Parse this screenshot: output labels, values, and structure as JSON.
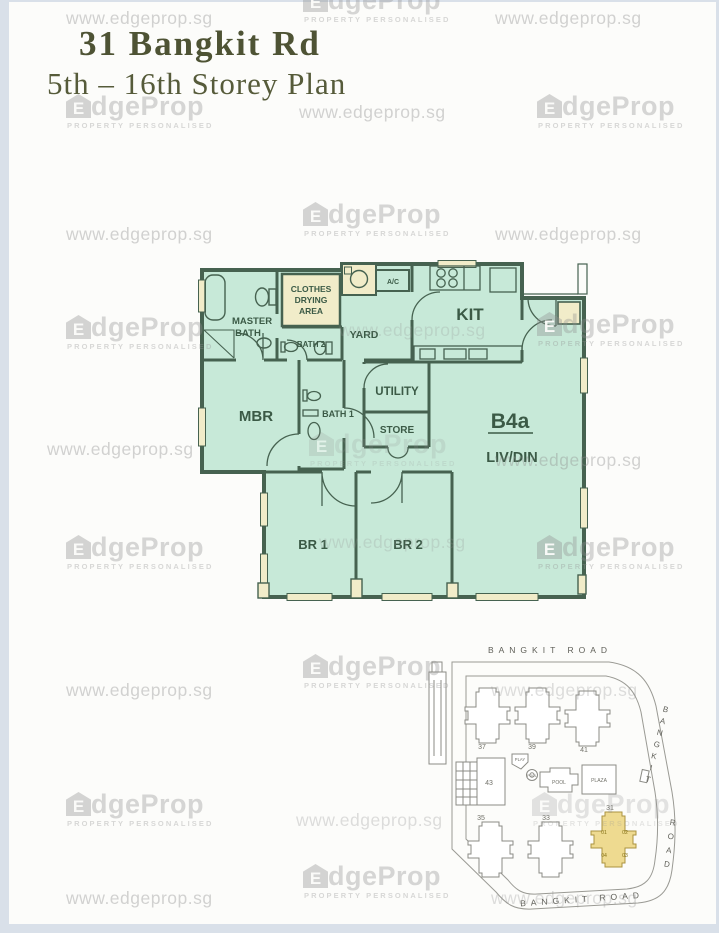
{
  "page": {
    "title": "31 Bangkit Rd",
    "subtitle": "5th – 16th Storey Plan"
  },
  "watermark": {
    "url": "www.edgeprop.sg",
    "brand_initial": "E",
    "brand_rest": "dgeProp",
    "tagline": "PROPERTY PERSONALISED"
  },
  "floor_plan": {
    "unit_type": "B4a",
    "rooms": {
      "master_bath_line1": "MASTER",
      "master_bath_line2": "BATH",
      "clothes_line1": "CLOTHES",
      "clothes_line2": "DRYING",
      "clothes_line3": "AREA",
      "ac": "A/C",
      "yard": "YARD",
      "kitchen": "KIT",
      "bath2": "BATH 2",
      "mbr": "MBR",
      "bath1": "BATH 1",
      "utility": "UTILITY",
      "store": "STORE",
      "livdin": "LIV/DIN",
      "br1": "BR 1",
      "br2": "BR 2"
    },
    "colors": {
      "fill": "#c7e9d8",
      "wall": "#466250",
      "cream": "#f1ecc9"
    }
  },
  "site_plan": {
    "road_top": "BANGKIT ROAD",
    "road_right_word1": "BANGKIT",
    "road_right_word2": "ROAD",
    "road_bottom": "BANGKIT ROAD",
    "blocks": [
      "37",
      "39",
      "41",
      "43",
      "35",
      "33",
      "31"
    ],
    "highlight_block": "31",
    "units": [
      "01",
      "02",
      "03",
      "04"
    ],
    "facilities": {
      "play": "PLAY",
      "pool_small": "POOL",
      "pool": "POOL",
      "plaza": "PLAZA"
    },
    "highlight_color": "#eeda90"
  }
}
